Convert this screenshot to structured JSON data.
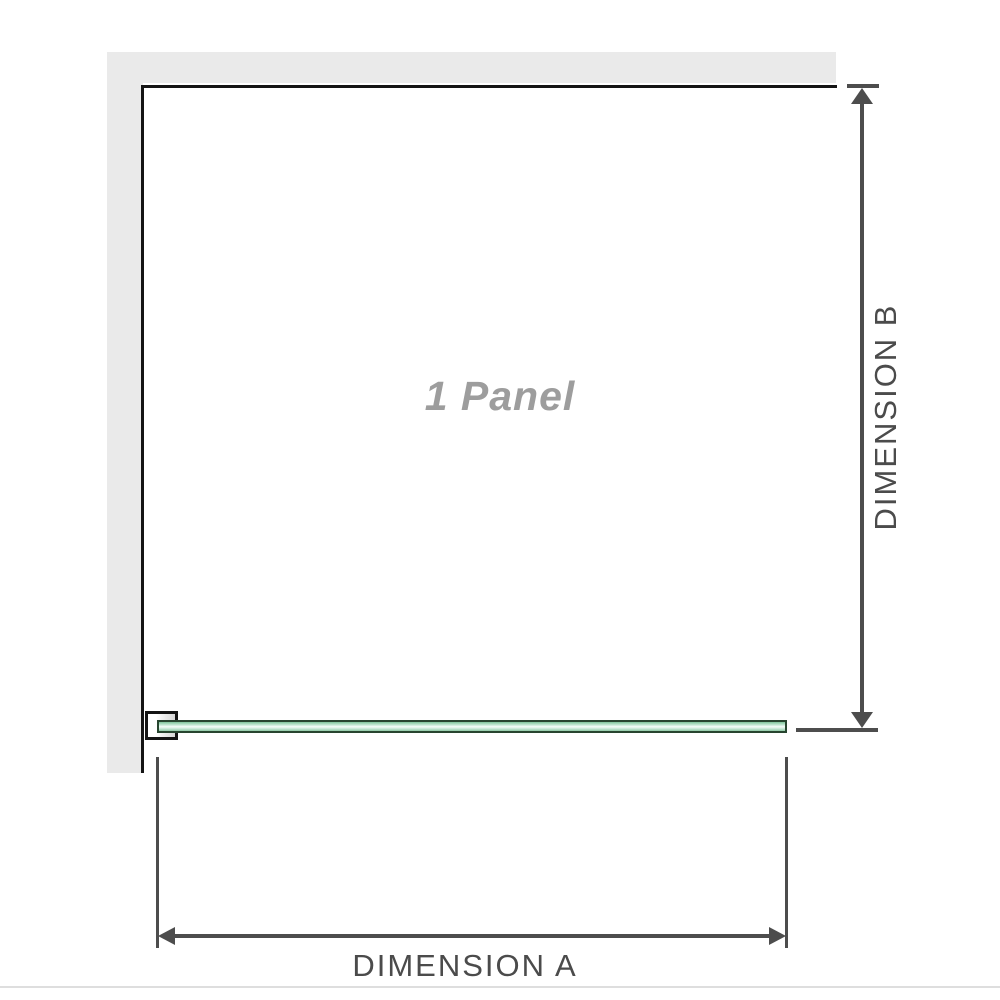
{
  "diagram": {
    "title": "Shower panel configuration diagram",
    "panel_label": "1 Panel",
    "dimension_a": {
      "label": "DIMENSION A",
      "axis": "horizontal",
      "measures": "panel width"
    },
    "dimension_b": {
      "label": "DIMENSION B",
      "axis": "vertical",
      "measures": "panel height"
    },
    "parts": {
      "wall": "L-shaped wall at top and left",
      "bracket": "wall mounting clamp at bottom left",
      "glass_panel": "green glass panel shown in top view along the bottom edge"
    },
    "colors": {
      "background": "#ffffff",
      "wall_fill": "#eaeaea",
      "panel_outline": "#141414",
      "dimension_line": "#4d4d4d",
      "dimension_label": "#4b4b4b",
      "panel_label_gray": "#9d9d9d",
      "glass_border": "#27452f",
      "glass_green": "#8fcaa5",
      "divider": "#dedede"
    }
  }
}
